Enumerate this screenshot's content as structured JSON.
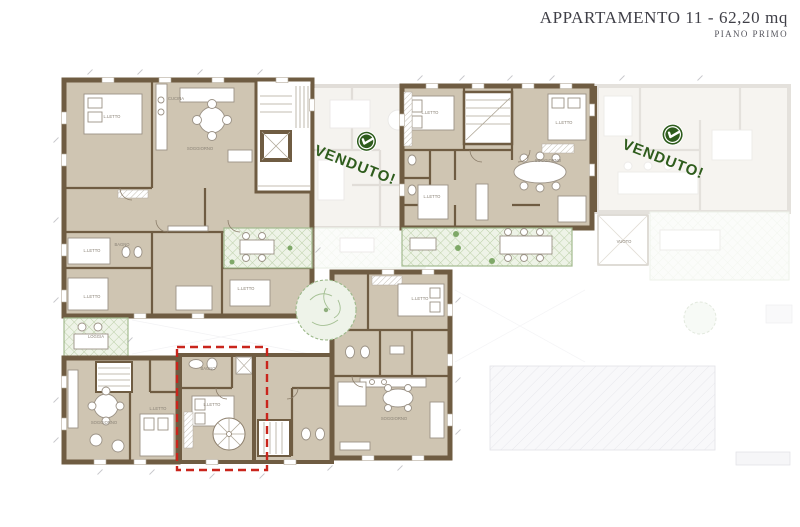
{
  "header": {
    "title": "APPARTAMENTO  11 - 62,20 mq",
    "subtitle": "PIANO PRIMO"
  },
  "stamps": [
    {
      "label": "VENDUTO!",
      "status": "sold",
      "unit": "top-middle"
    },
    {
      "label": "VENDUTO!",
      "status": "sold",
      "unit": "top-right"
    }
  ],
  "highlight": {
    "label": "Appartamento 11",
    "style": "red-dashed-outline"
  },
  "colors": {
    "wall": "#6f5c42",
    "floor": "#cfc5b2",
    "terrace": "#a3bb90",
    "stamp_green": "#2e5c1c",
    "highlight_red": "#c9251c",
    "title_text": "#3f3f47"
  },
  "rooms": [
    {
      "text": "L.LETTO",
      "x": 112,
      "y": 118
    },
    {
      "text": "CUCINA",
      "x": 176,
      "y": 100
    },
    {
      "text": "SOGGIORNO",
      "x": 200,
      "y": 150
    },
    {
      "text": "BAGNO",
      "x": 122,
      "y": 246
    },
    {
      "text": "L.LETTO",
      "x": 92,
      "y": 252
    },
    {
      "text": "L.LETTO",
      "x": 92,
      "y": 298
    },
    {
      "text": "L.LETTO",
      "x": 246,
      "y": 290
    },
    {
      "text": "LOGGIA",
      "x": 96,
      "y": 338
    },
    {
      "text": "L.LETTO",
      "x": 430,
      "y": 114
    },
    {
      "text": "L.LETTO",
      "x": 564,
      "y": 124
    },
    {
      "text": "SOGGIORNO",
      "x": 548,
      "y": 162
    },
    {
      "text": "L.LETTO",
      "x": 432,
      "y": 198
    },
    {
      "text": "SOGGIORNO",
      "x": 104,
      "y": 424
    },
    {
      "text": "L.LETTO",
      "x": 158,
      "y": 410
    },
    {
      "text": "BAGNO",
      "x": 208,
      "y": 370
    },
    {
      "text": "L.LETTO",
      "x": 212,
      "y": 406
    },
    {
      "text": "L.LETTO",
      "x": 420,
      "y": 300
    },
    {
      "text": "SOGGIORNO",
      "x": 394,
      "y": 420
    },
    {
      "text": "VUOTO",
      "x": 624,
      "y": 243
    }
  ]
}
